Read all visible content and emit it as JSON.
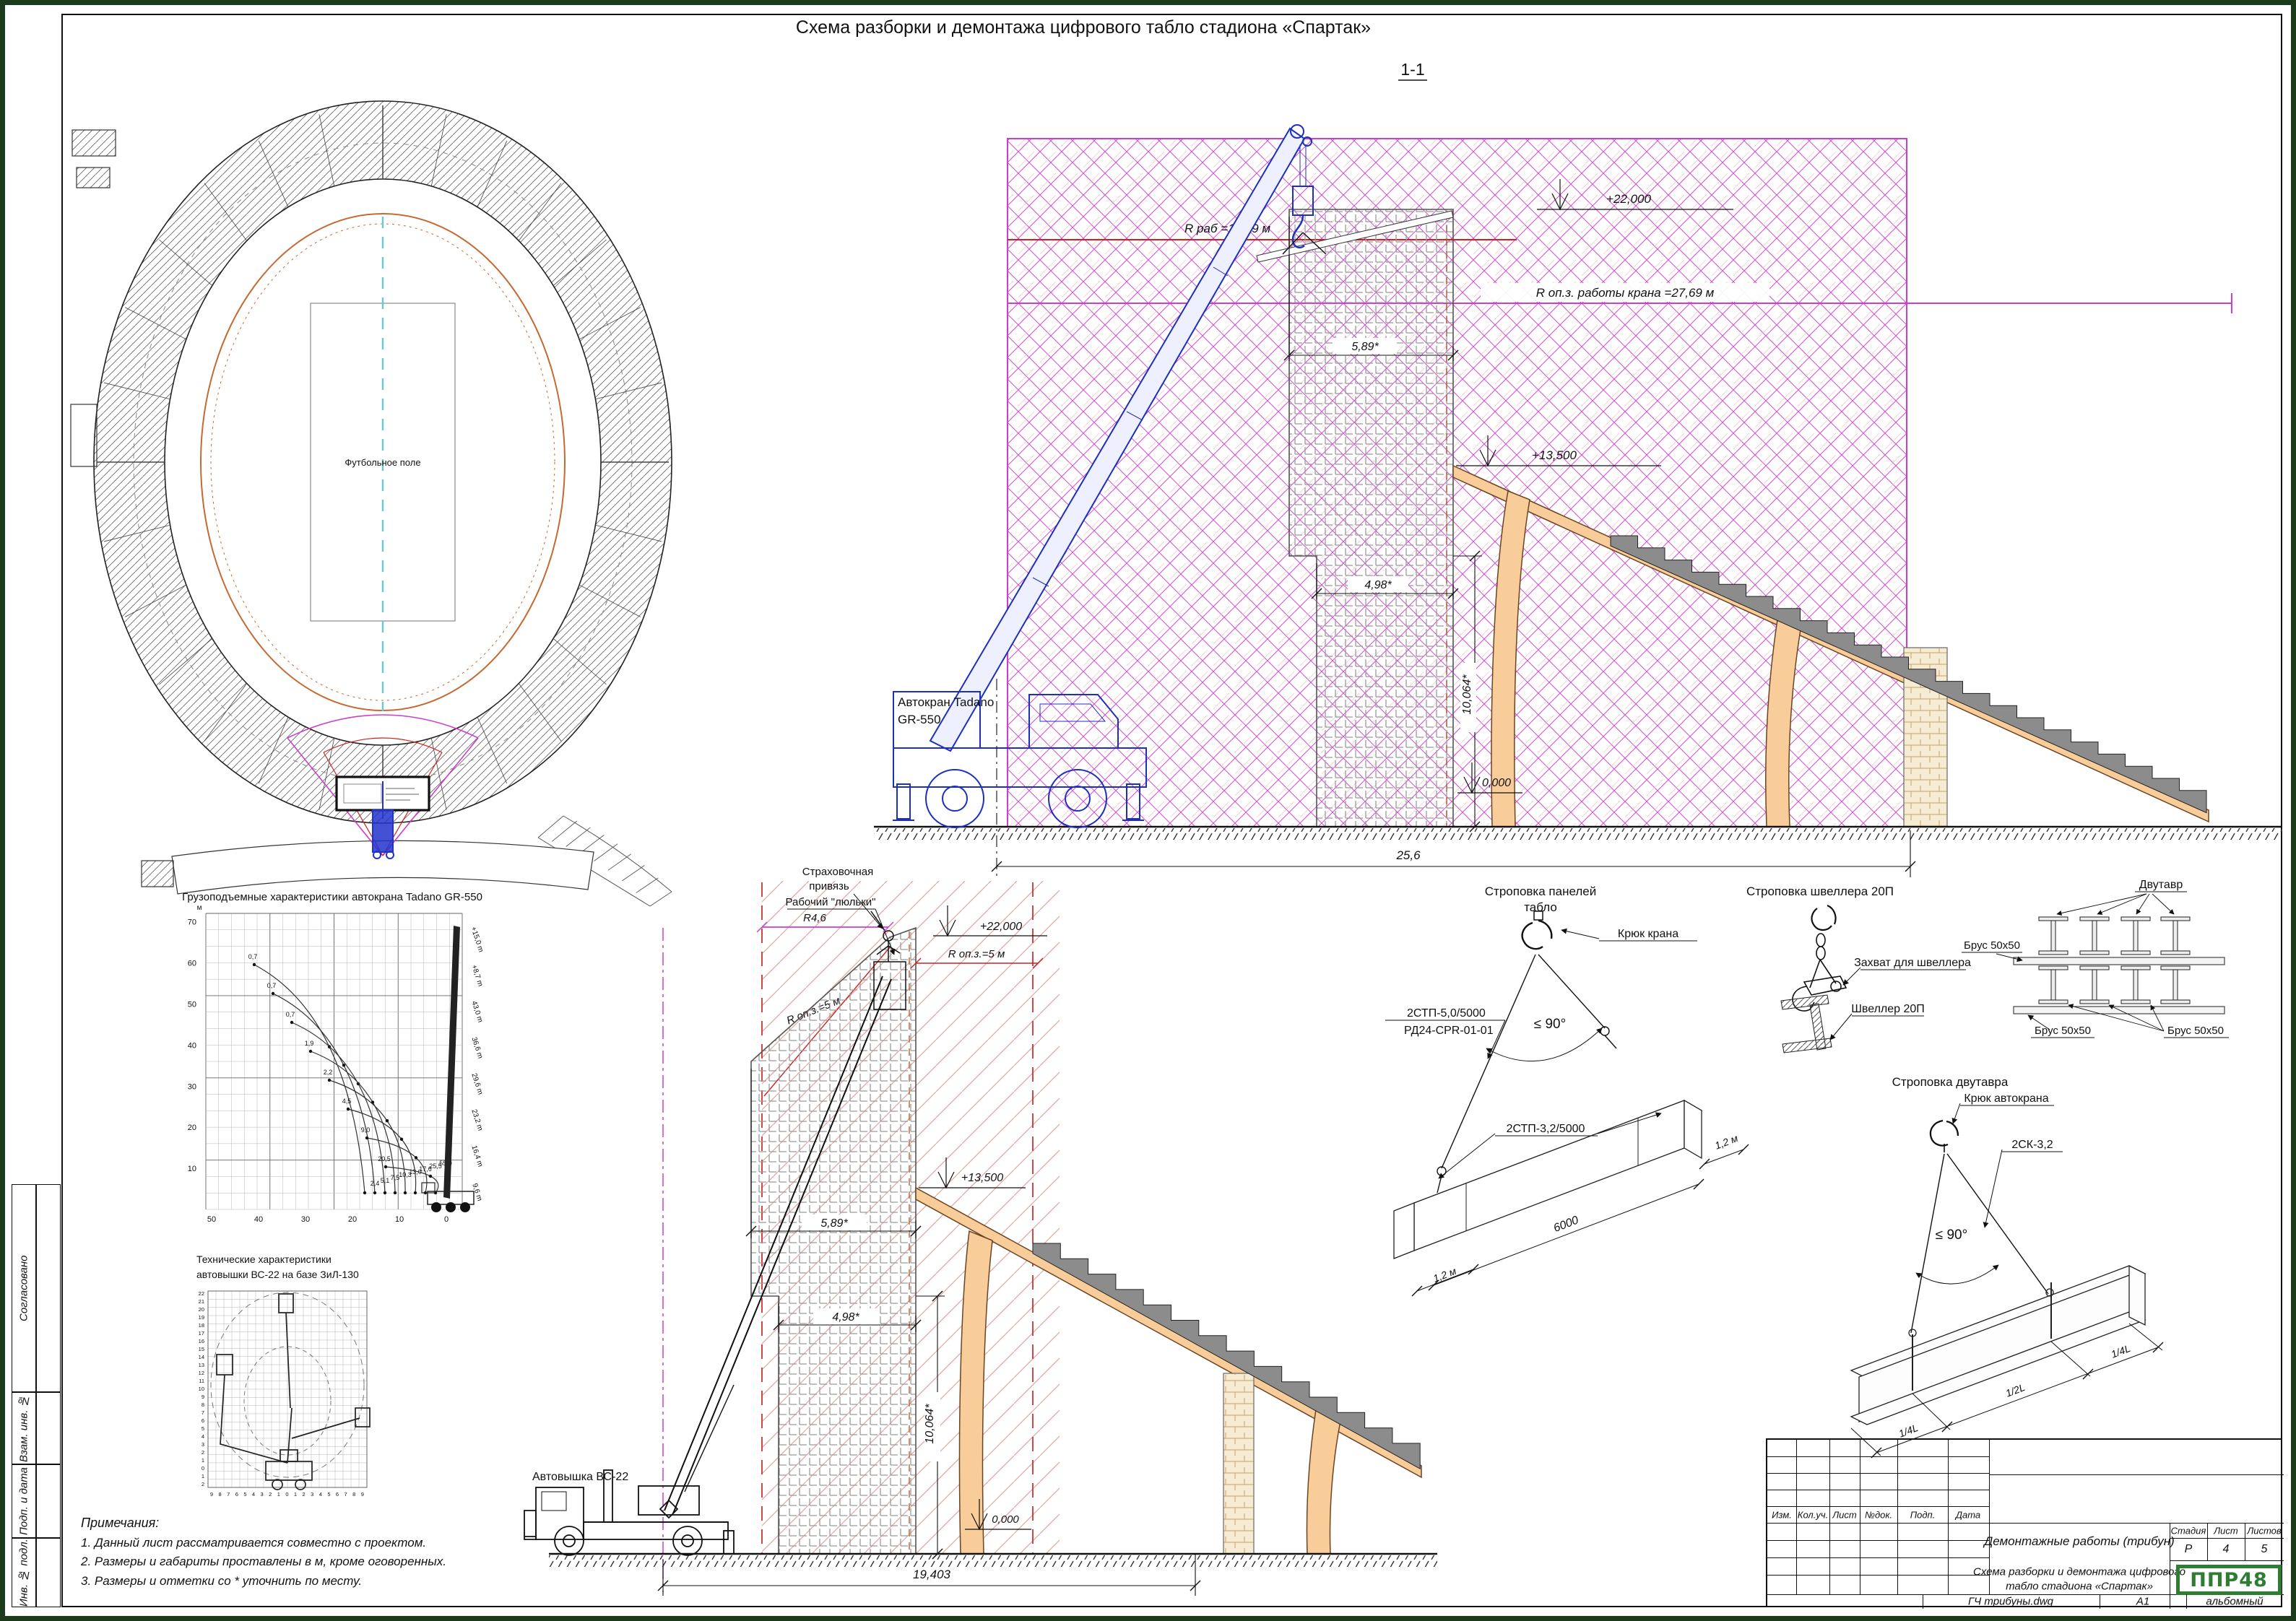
{
  "sheet": {
    "title": "Схема разборки и демонтажа цифрового табло стадиона «Спартак»",
    "section_mark": "1-1"
  },
  "margin": {
    "approved": "Сог­ласовано",
    "replace_inv": "Взам. инв. №",
    "sign_date": "Подп. и дата",
    "inv_no": "Инв. № подл."
  },
  "plan": {
    "field": "Футбольное поле"
  },
  "crane": {
    "name1": "Автокран Tadano",
    "name2": "GR-550",
    "elev_top": "+22,000",
    "elev_mid": "+13,500",
    "elev_zero": "0,000",
    "r_rab": "R раб =12,69 м",
    "r_opz": "R оп.з. работы крана =27,69 м",
    "dim_w1": "5,89*",
    "dim_w2": "4,98*",
    "dim_h": "10,064*",
    "dim_span": "25,6"
  },
  "lift": {
    "name": "Автовышка ВС-22",
    "harness1": "Страховочная",
    "harness2": "привязь",
    "worker": "Рабочий \"люльки\"",
    "r46": "R4,6",
    "elev_top": "+22,000",
    "elev_mid": "+13,500",
    "elev_zero": "0,000",
    "r_opz_right": "R оп.з.=5 м",
    "r_opz_left": "R оп.з.=5 м",
    "dim_w1": "5,89*",
    "dim_w2": "4,98*",
    "dim_h": "10,064*",
    "dim_span": "19,403"
  },
  "load_chart": {
    "type": "line",
    "title": "Грузоподъемные характеристики автокрана Tadano GR-550",
    "unit": "м",
    "y_ticks": [
      "70",
      "60",
      "50",
      "40",
      "30",
      "20",
      "10"
    ],
    "x_ticks": [
      "50",
      "40",
      "30",
      "20",
      "10",
      "0"
    ],
    "boom_labels": [
      "+15,0 m",
      "+8,7 m",
      "43,0 m",
      "36,6 m",
      "29,6 m",
      "23,2 m",
      "16,4 m",
      "9,6 m"
    ],
    "left_labels": [
      "0,7",
      "0,7",
      "0,7",
      "1,9",
      "2,2",
      "4,5",
      "9,0",
      "20,5"
    ],
    "right_labels": [
      "2,4",
      "5,1",
      "7,5",
      "10,3",
      "13,0",
      "17,6",
      "25,5",
      "55,0"
    ]
  },
  "lift_chart": {
    "title1": "Технические характеристики",
    "title2": "автовышки ВС-22 на базе ЗиЛ-130",
    "y_max": 22,
    "y_min": -2,
    "x_ticks": [
      "9",
      "8",
      "7",
      "6",
      "5",
      "4",
      "3",
      "2",
      "1",
      "0",
      "1",
      "2",
      "3",
      "4",
      "5",
      "6",
      "7",
      "8",
      "9"
    ]
  },
  "notes": {
    "title": "Примечания:",
    "items": [
      "1. Данный лист рассматривается совместно с проектом.",
      "2. Размеры и габариты проставлены в м, кроме оговоренных.",
      "3. Размеры и отметки со * уточнить по месту."
    ]
  },
  "rig_panel": {
    "title1": "Строповка панелей",
    "title2": "табло",
    "hook": "Крюк крана",
    "sling1": "2СТП-5,0/5000",
    "sling1b": "РД24-СРR-01-01",
    "angle": "≤ 90°",
    "sling2": "2СТП-3,2/5000",
    "len": "6000",
    "end1": "1,2 м",
    "end2": "1,2 м"
  },
  "rig_channel": {
    "title": "Строповка швеллера 20П",
    "grab": "Захват для швеллера",
    "item": "Швеллер 20П"
  },
  "beam_stack": {
    "beam": "Двутавр",
    "brus1": "Брус 50x50",
    "brus2": "Брус 50x50",
    "brus3": "Брус 50x50"
  },
  "rig_beam": {
    "title": "Строповка двутавра",
    "hook": "Крюк автокрана",
    "sling": "2СК-3,2",
    "angle": "≤ 90°",
    "d1": "1/4L",
    "d2": "1/2L",
    "d3": "1/4L"
  },
  "title_block": {
    "headers": [
      "Изм.",
      "Кол.уч.",
      "Лист",
      "№док.",
      "Подп.",
      "Дата"
    ],
    "doc_type": "Демонтажные работы (трибун)",
    "stage_h": "Стадия",
    "sheet_h": "Лист",
    "sheets_h": "Листов",
    "stage": "Р",
    "sheet": "4",
    "sheets": "5",
    "title1": "Схема разборки и демонтажа цифрового",
    "title2": "табло стадиона «Спартак»",
    "logo": "ППР48",
    "file": "ГЧ трибуны.dwg",
    "format": "А1",
    "orientation": "альбомный"
  },
  "colors": {
    "magenta": "#cc3fcc",
    "red": "#cc2222",
    "orange": "#f8cd9a",
    "blue": "#1d2fbf",
    "green": "#2e7d32"
  }
}
